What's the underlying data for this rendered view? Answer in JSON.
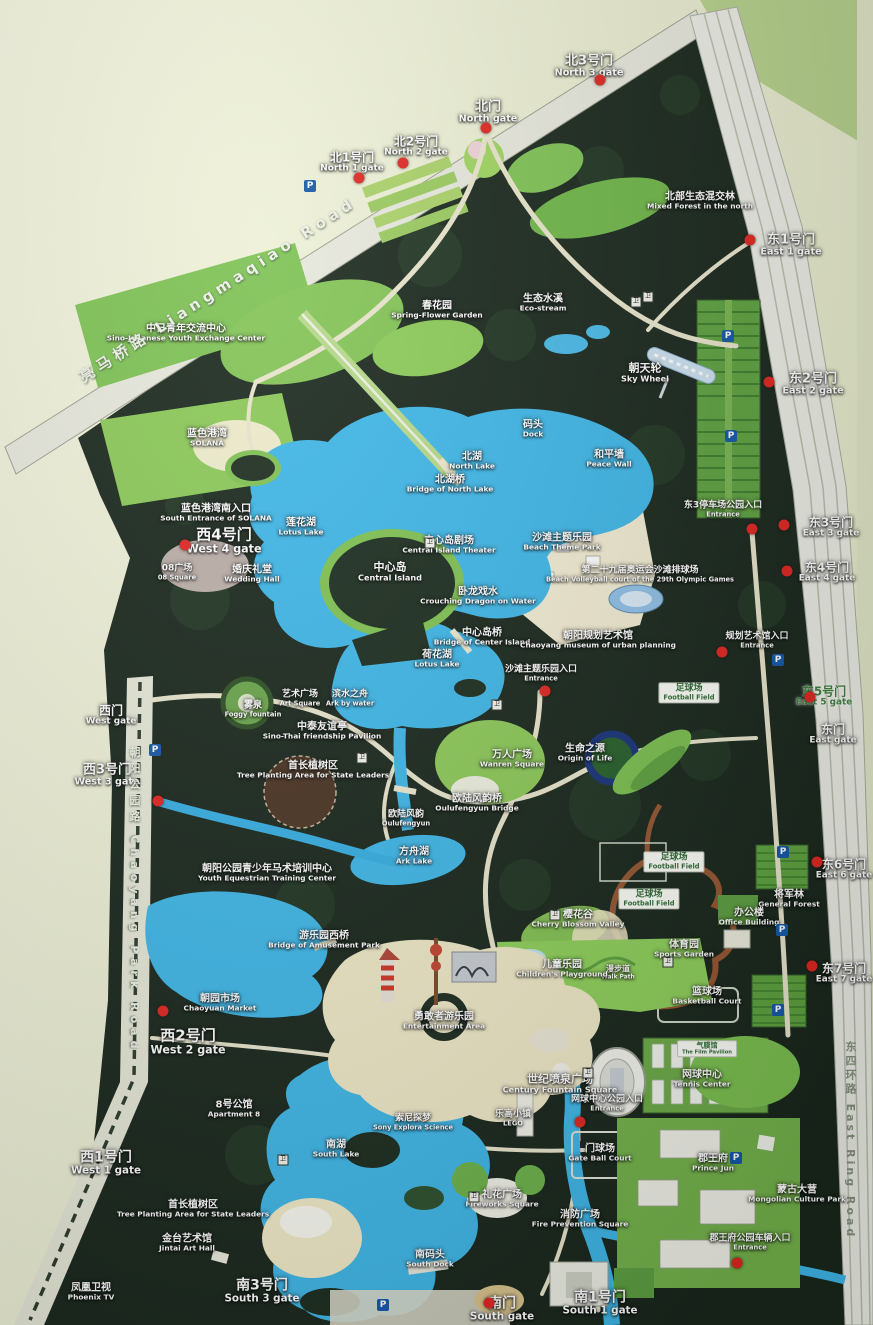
{
  "map": {
    "colors": {
      "forest": "#19271c",
      "lake": "#3eb7e8",
      "lawn": "#7dc253",
      "road": "#e7e8dc",
      "margin": "#ecefd4",
      "gate_dot": "#e02520",
      "beige": "#f0e9c8"
    },
    "labels": [
      {
        "zh": "北1号门",
        "en": "North 1 gate",
        "x": 352,
        "y": 163,
        "s": 12
      },
      {
        "zh": "北2号门",
        "en": "North 2 gate",
        "x": 416,
        "y": 147,
        "s": 12
      },
      {
        "zh": "北门",
        "en": "North gate",
        "x": 488,
        "y": 113,
        "s": 13
      },
      {
        "zh": "北3号门",
        "en": "North 3 gate",
        "x": 589,
        "y": 67,
        "s": 13
      },
      {
        "zh": "北部生态混交林",
        "en": "Mixed Forest in the north",
        "x": 700,
        "y": 201,
        "s": 10
      },
      {
        "zh": "东1号门",
        "en": "East 1 gate",
        "x": 791,
        "y": 246,
        "s": 13
      },
      {
        "zh": "中日青年交流中心",
        "en": "Sino-Japanese Youth Exchange Center",
        "x": 186,
        "y": 333,
        "s": 10
      },
      {
        "zh": "春花园",
        "en": "Spring-Flower Garden",
        "x": 437,
        "y": 310,
        "s": 10
      },
      {
        "zh": "生态水溪",
        "en": "Eco-stream",
        "x": 543,
        "y": 303,
        "s": 10
      },
      {
        "zh": "朝天轮",
        "en": "Sky Wheel",
        "x": 645,
        "y": 373,
        "s": 11
      },
      {
        "zh": "东2号门",
        "en": "East 2 gate",
        "x": 813,
        "y": 385,
        "s": 13
      },
      {
        "zh": "蓝色港湾",
        "en": "SOLANA",
        "x": 207,
        "y": 438,
        "s": 10
      },
      {
        "zh": "码头",
        "en": "Dock",
        "x": 533,
        "y": 429,
        "s": 10
      },
      {
        "zh": "北湖",
        "en": "North Lake",
        "x": 472,
        "y": 461,
        "s": 10
      },
      {
        "zh": "和平墙",
        "en": "Peace Wall",
        "x": 609,
        "y": 459,
        "s": 10
      },
      {
        "zh": "北湖桥",
        "en": "Bridge of North Lake",
        "x": 450,
        "y": 484,
        "s": 10
      },
      {
        "zh": "蓝色港湾南入口",
        "en": "South Entrance of SOLANA",
        "x": 216,
        "y": 513,
        "s": 10,
        "w": 120
      },
      {
        "zh": "西4号门",
        "en": "West 4 gate",
        "x": 224,
        "y": 541,
        "s": 15
      },
      {
        "zh": "莲花湖",
        "en": "Lotus Lake",
        "x": 301,
        "y": 527,
        "s": 10
      },
      {
        "zh": "中心岛剧场",
        "en": "Central Island Theater",
        "x": 449,
        "y": 545,
        "s": 10
      },
      {
        "zh": "沙滩主题乐园",
        "en": "Beach Theme Park",
        "x": 562,
        "y": 542,
        "s": 10
      },
      {
        "zh": "第二十九届奥运会沙滩排球场",
        "en": "Beach Volleyball court of the 29th Olympic Games",
        "x": 640,
        "y": 575,
        "s": 9
      },
      {
        "zh": "东3停车场公园入口",
        "en": "Entrance",
        "x": 723,
        "y": 510,
        "s": 9
      },
      {
        "zh": "东3号门",
        "en": "East 3 gate",
        "x": 831,
        "y": 528,
        "s": 12
      },
      {
        "zh": "东4号门",
        "en": "East 4 gate",
        "x": 827,
        "y": 573,
        "s": 12
      },
      {
        "zh": "中心岛",
        "en": "Central Island",
        "x": 390,
        "y": 572,
        "s": 11
      },
      {
        "zh": "08广场",
        "en": "08 Square",
        "x": 177,
        "y": 573,
        "s": 9
      },
      {
        "zh": "婚庆礼堂",
        "en": "Wedding Hall",
        "x": 252,
        "y": 574,
        "s": 10
      },
      {
        "zh": "卧龙戏水",
        "en": "Crouching Dragon on Water",
        "x": 478,
        "y": 596,
        "s": 10
      },
      {
        "zh": "中心岛桥",
        "en": "Bridge of Center Island",
        "x": 482,
        "y": 637,
        "s": 10
      },
      {
        "zh": "朝阳规划艺术馆",
        "en": "Chaoyang museum of urban planning",
        "x": 598,
        "y": 640,
        "s": 10
      },
      {
        "zh": "规划艺术馆入口",
        "en": "Entrance",
        "x": 757,
        "y": 641,
        "s": 9
      },
      {
        "zh": "荷花湖",
        "en": "Lotus Lake",
        "x": 437,
        "y": 659,
        "s": 10
      },
      {
        "zh": "沙滩主题乐园入口",
        "en": "Entrance",
        "x": 541,
        "y": 674,
        "s": 9
      },
      {
        "zh": "足球场",
        "en": "Football Field",
        "x": 689,
        "y": 693,
        "s": 9,
        "c": "box"
      },
      {
        "zh": "东5号门",
        "en": "East 5 gate",
        "x": 824,
        "y": 697,
        "s": 12,
        "c": "green"
      },
      {
        "zh": "东门",
        "en": "East gate",
        "x": 833,
        "y": 735,
        "s": 12
      },
      {
        "zh": "西门",
        "en": "West gate",
        "x": 111,
        "y": 716,
        "s": 12
      },
      {
        "zh": "雾泉",
        "en": "Foggy fountain",
        "x": 253,
        "y": 710,
        "s": 9
      },
      {
        "zh": "艺术广场",
        "en": "Art Square",
        "x": 300,
        "y": 699,
        "s": 9
      },
      {
        "zh": "滨水之舟",
        "en": "Ark by water",
        "x": 350,
        "y": 699,
        "s": 9
      },
      {
        "zh": "中泰友谊亭",
        "en": "Sino-Thai friendship Pavilion",
        "x": 322,
        "y": 731,
        "s": 10
      },
      {
        "zh": "万人广场",
        "en": "Wanren Square",
        "x": 512,
        "y": 759,
        "s": 10
      },
      {
        "zh": "生命之源",
        "en": "Origin of Life",
        "x": 585,
        "y": 753,
        "s": 10
      },
      {
        "zh": "首长植树区",
        "en": "Tree Planting Area for State Leaders",
        "x": 313,
        "y": 770,
        "s": 10
      },
      {
        "zh": "西3号门",
        "en": "West 3 gate",
        "x": 107,
        "y": 776,
        "s": 13
      },
      {
        "zh": "欧陆风韵桥",
        "en": "Oulufengyun Bridge",
        "x": 477,
        "y": 803,
        "s": 10
      },
      {
        "zh": "欧陆风韵",
        "en": "Oulufengyun",
        "x": 406,
        "y": 819,
        "s": 9
      },
      {
        "zh": "方舟湖",
        "en": "Ark Lake",
        "x": 414,
        "y": 856,
        "s": 10
      },
      {
        "zh": "朝阳公园青少年马术培训中心",
        "en": "Youth Equestrian Training Center",
        "x": 267,
        "y": 873,
        "s": 10
      },
      {
        "zh": "足球场",
        "en": "Football Field",
        "x": 674,
        "y": 862,
        "s": 9,
        "c": "box"
      },
      {
        "zh": "东6号门",
        "en": "East 6 gate",
        "x": 844,
        "y": 870,
        "s": 12
      },
      {
        "zh": "将军林",
        "en": "General Forest",
        "x": 789,
        "y": 899,
        "s": 10
      },
      {
        "zh": "足球场",
        "en": "Football Field",
        "x": 649,
        "y": 899,
        "s": 9,
        "c": "box"
      },
      {
        "zh": "办公楼",
        "en": "Office Building",
        "x": 749,
        "y": 917,
        "s": 10
      },
      {
        "zh": "樱花谷",
        "en": "Cherry Blossom Valley",
        "x": 578,
        "y": 919,
        "s": 10
      },
      {
        "zh": "游乐园西桥",
        "en": "Bridge of Amusement Park",
        "x": 324,
        "y": 940,
        "s": 10
      },
      {
        "zh": "体育园",
        "en": "Sports Garden",
        "x": 684,
        "y": 949,
        "s": 10
      },
      {
        "zh": "漫步道",
        "en": "Walk Path",
        "x": 618,
        "y": 973,
        "s": 8
      },
      {
        "zh": "东7号门",
        "en": "East 7 gate",
        "x": 844,
        "y": 974,
        "s": 12
      },
      {
        "zh": "儿童乐园",
        "en": "Children's Playground",
        "x": 562,
        "y": 969,
        "s": 10
      },
      {
        "zh": "篮球场",
        "en": "Basketball Court",
        "x": 707,
        "y": 996,
        "s": 10
      },
      {
        "zh": "朝园市场",
        "en": "Chaoyuan Market",
        "x": 220,
        "y": 1003,
        "s": 10
      },
      {
        "zh": "勇敢者游乐园",
        "en": "Entertainment Area",
        "x": 444,
        "y": 1021,
        "s": 10
      },
      {
        "zh": "西2号门",
        "en": "West 2 gate",
        "x": 188,
        "y": 1042,
        "s": 15
      },
      {
        "zh": "气膜馆",
        "en": "The Film Pavilion",
        "x": 707,
        "y": 1049,
        "s": 7,
        "c": "box"
      },
      {
        "zh": "世纪喷泉广场",
        "en": "Century Fountain Square",
        "x": 560,
        "y": 1084,
        "s": 11
      },
      {
        "zh": "网球中心",
        "en": "Tennis Center",
        "x": 702,
        "y": 1079,
        "s": 10
      },
      {
        "zh": "网球中心公园入口",
        "en": "Entrance",
        "x": 607,
        "y": 1104,
        "s": 9
      },
      {
        "zh": "8号公馆",
        "en": "Apartment 8",
        "x": 234,
        "y": 1109,
        "s": 10
      },
      {
        "zh": "索尼探梦",
        "en": "Sony Explora Science",
        "x": 413,
        "y": 1123,
        "s": 9
      },
      {
        "zh": "乐高小镇",
        "en": "LEGO",
        "x": 513,
        "y": 1119,
        "s": 9
      },
      {
        "zh": "南湖",
        "en": "South Lake",
        "x": 336,
        "y": 1149,
        "s": 10
      },
      {
        "zh": "门球场",
        "en": "Gate Ball Court",
        "x": 600,
        "y": 1153,
        "s": 10
      },
      {
        "zh": "郡王府",
        "en": "Prince Jun",
        "x": 713,
        "y": 1163,
        "s": 10
      },
      {
        "zh": "西1号门",
        "en": "West 1 gate",
        "x": 106,
        "y": 1164,
        "s": 14
      },
      {
        "zh": "礼花广场",
        "en": "Fireworks Square",
        "x": 502,
        "y": 1199,
        "s": 10
      },
      {
        "zh": "蒙古大营",
        "en": "Mongolian Culture Park",
        "x": 797,
        "y": 1194,
        "s": 10,
        "w": 104
      },
      {
        "zh": "消防广场",
        "en": "Fire Prevention Square",
        "x": 580,
        "y": 1219,
        "s": 10
      },
      {
        "zh": "首长植树区",
        "en": "Tree Planting Area for State Leaders",
        "x": 193,
        "y": 1209,
        "s": 10
      },
      {
        "zh": "金台艺术馆",
        "en": "Jintai Art Hall",
        "x": 187,
        "y": 1243,
        "s": 10
      },
      {
        "zh": "郡王府公园车辆入口",
        "en": "Entrance",
        "x": 750,
        "y": 1243,
        "s": 9
      },
      {
        "zh": "南码头",
        "en": "South Dock",
        "x": 430,
        "y": 1259,
        "s": 10
      },
      {
        "zh": "凤凰卫视",
        "en": "Phoenix TV",
        "x": 91,
        "y": 1292,
        "s": 10
      },
      {
        "zh": "南3号门",
        "en": "South 3 gate",
        "x": 262,
        "y": 1292,
        "s": 14
      },
      {
        "zh": "南门",
        "en": "South gate",
        "x": 502,
        "y": 1310,
        "s": 14
      },
      {
        "zh": "南1号门",
        "en": "South 1 gate",
        "x": 600,
        "y": 1304,
        "s": 14
      },
      {
        "zh": "亮马桥路 Liangmaqiao Road",
        "en": "",
        "x": 218,
        "y": 290,
        "s": 15,
        "c": "roadtext",
        "r": -33
      },
      {
        "zh": "朝阳公园路 Chaoyang Park Road",
        "en": "",
        "x": 134,
        "y": 900,
        "s": 11,
        "c": "roadtext vert"
      },
      {
        "zh": "东四环路 East Ring Road",
        "en": "",
        "x": 850,
        "y": 1140,
        "s": 11,
        "c": "grayroad vert"
      }
    ],
    "markers": [
      [
        359,
        178
      ],
      [
        403,
        163
      ],
      [
        486,
        128
      ],
      [
        600,
        80
      ],
      [
        750,
        240
      ],
      [
        769,
        382
      ],
      [
        185,
        545
      ],
      [
        752,
        529
      ],
      [
        784,
        525
      ],
      [
        787,
        571
      ],
      [
        722,
        652
      ],
      [
        545,
        691
      ],
      [
        158,
        801
      ],
      [
        163,
        1011
      ],
      [
        580,
        1122
      ],
      [
        812,
        966
      ],
      [
        817,
        862
      ],
      [
        737,
        1263
      ],
      [
        810,
        697
      ],
      [
        489,
        1303
      ]
    ],
    "parking_icons": [
      [
        310,
        186
      ],
      [
        728,
        336
      ],
      [
        731,
        436
      ],
      [
        778,
        660
      ],
      [
        783,
        852
      ],
      [
        782,
        930
      ],
      [
        778,
        1010
      ],
      [
        155,
        750
      ],
      [
        383,
        1305
      ],
      [
        736,
        1158
      ]
    ],
    "amenity_icons": [
      [
        636,
        302
      ],
      [
        648,
        297
      ],
      [
        430,
        543
      ],
      [
        497,
        705
      ],
      [
        362,
        758
      ],
      [
        588,
        1073
      ],
      [
        474,
        1197
      ],
      [
        283,
        1160
      ],
      [
        555,
        915
      ],
      [
        668,
        962
      ]
    ],
    "amenity_glyph": "卫",
    "parking_glyph": "P"
  }
}
